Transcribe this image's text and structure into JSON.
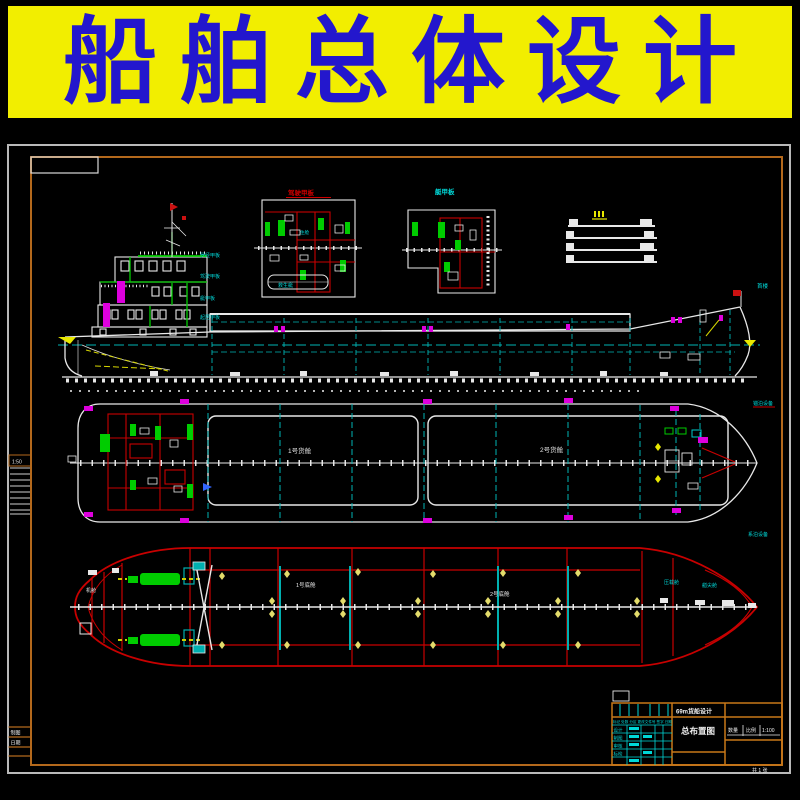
{
  "banner": {
    "title": "船舶总体设计",
    "bg_color": "#f2ee00",
    "text_color": "#2317cd"
  },
  "drawing": {
    "bg_color": "#000000",
    "frame_color": "#b4691c",
    "border_color": "#b9b9b9",
    "line_colors": {
      "white": "#e8e8e8",
      "red": "#c80000",
      "green": "#00cc00",
      "cyan": "#00b4b4",
      "magenta": "#dd00dd",
      "yellow": "#e8e800",
      "star_yellow": "#e3dc6b"
    },
    "margin": {
      "scale_label": "1:50",
      "row1": "制图",
      "row2": "日期"
    },
    "details": {
      "detail_a_title": "驾驶甲板",
      "detail_b_title": "艇甲板",
      "lifeboat_label": "救生艇",
      "cabin_label": "住舱",
      "mast_light_label": "桅灯"
    },
    "side_view": {
      "deck_labels": [
        "罗经甲板",
        "驾驶甲板",
        "艇甲板",
        "起居甲板"
      ],
      "bow_label": "首楼"
    },
    "plan_view": {
      "hold1_label": "1号货舱",
      "hold2_label": "2号货舱",
      "bow_label_top": "锚泊设备",
      "bow_label_bottom": "系泊设备"
    },
    "bottom_view": {
      "engine_room_label": "机舱",
      "hold1_label": "1号底舱",
      "hold2_label": "2号底舱",
      "bow_label_cyan1": "压载舱",
      "bow_label_cyan2": "艏尖舱",
      "stars": [
        [
          222,
          576
        ],
        [
          287,
          574
        ],
        [
          358,
          572
        ],
        [
          433,
          574
        ],
        [
          503,
          573
        ],
        [
          578,
          573
        ],
        [
          272,
          601
        ],
        [
          272,
          614
        ],
        [
          343,
          601
        ],
        [
          343,
          614
        ],
        [
          418,
          601
        ],
        [
          418,
          614
        ],
        [
          488,
          601
        ],
        [
          488,
          614
        ],
        [
          558,
          601
        ],
        [
          558,
          614
        ],
        [
          637,
          601
        ],
        [
          637,
          614
        ],
        [
          222,
          645
        ],
        [
          287,
          645
        ],
        [
          358,
          645
        ],
        [
          433,
          645
        ],
        [
          503,
          645
        ],
        [
          578,
          645
        ]
      ]
    },
    "title_block": {
      "header_row": "标记 处数 分区 更改文件号 签字 日期",
      "rows": [
        "设计",
        "制图",
        "审核",
        "标检"
      ],
      "project": "69m货船设计",
      "drawing_name": "总布置图",
      "cell1": "数量",
      "cell2": "比例",
      "cell3": "1:100",
      "sheet_note": "共 1 张"
    }
  }
}
